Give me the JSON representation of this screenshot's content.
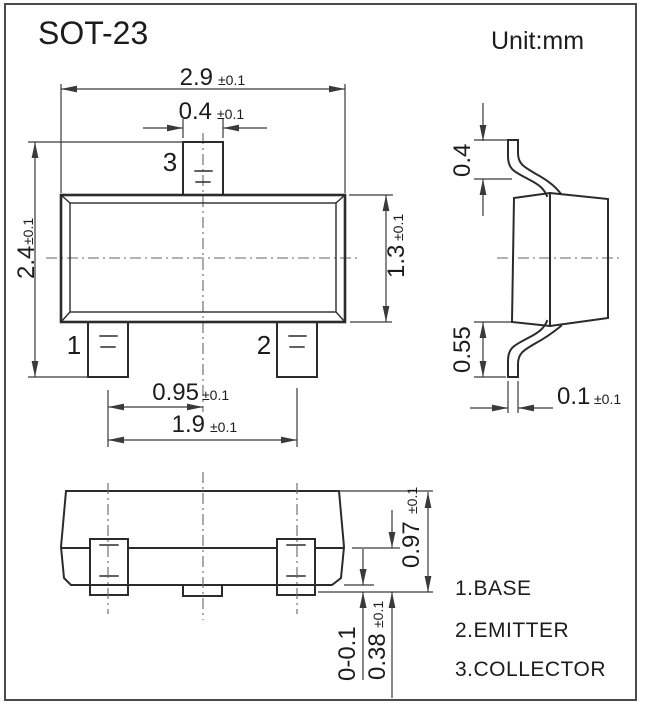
{
  "title": "SOT-23",
  "unit": "Unit:mm",
  "front": {
    "body_width": {
      "v": "2.9",
      "t": "±0.1"
    },
    "lead3_width": {
      "v": "0.4",
      "t": "±0.1"
    },
    "total_height": {
      "v": "2.4",
      "t": "±0.1"
    },
    "body_height": {
      "v": "1.3",
      "t": "±0.1"
    },
    "lead_pitch": {
      "v": "0.95",
      "t": "±0.1"
    },
    "lead_span": {
      "v": "1.9",
      "t": "±0.1"
    },
    "pins": {
      "p1": "1",
      "p2": "2",
      "p3": "3"
    }
  },
  "side": {
    "lead_top": {
      "v": "0.4"
    },
    "lead_bottom": {
      "v": "0.55"
    },
    "lead_thickness": {
      "v": "0.1",
      "t": "±0.1"
    }
  },
  "bottom": {
    "height_total": {
      "v": "0.97",
      "t": "±0.1"
    },
    "lead_height": {
      "v": "0.38",
      "t": "±0.1"
    },
    "standoff": {
      "v": "0-0.1"
    }
  },
  "legend": {
    "items": [
      "1.BASE",
      "2.EMITTER",
      "3.COLLECTOR"
    ]
  },
  "colors": {
    "line": "#2b2b2b",
    "dim": "#3a3a3a",
    "text": "#1c1c1e",
    "centerline": "#666666",
    "border": "#4b4b4b",
    "background": "#ffffff"
  }
}
